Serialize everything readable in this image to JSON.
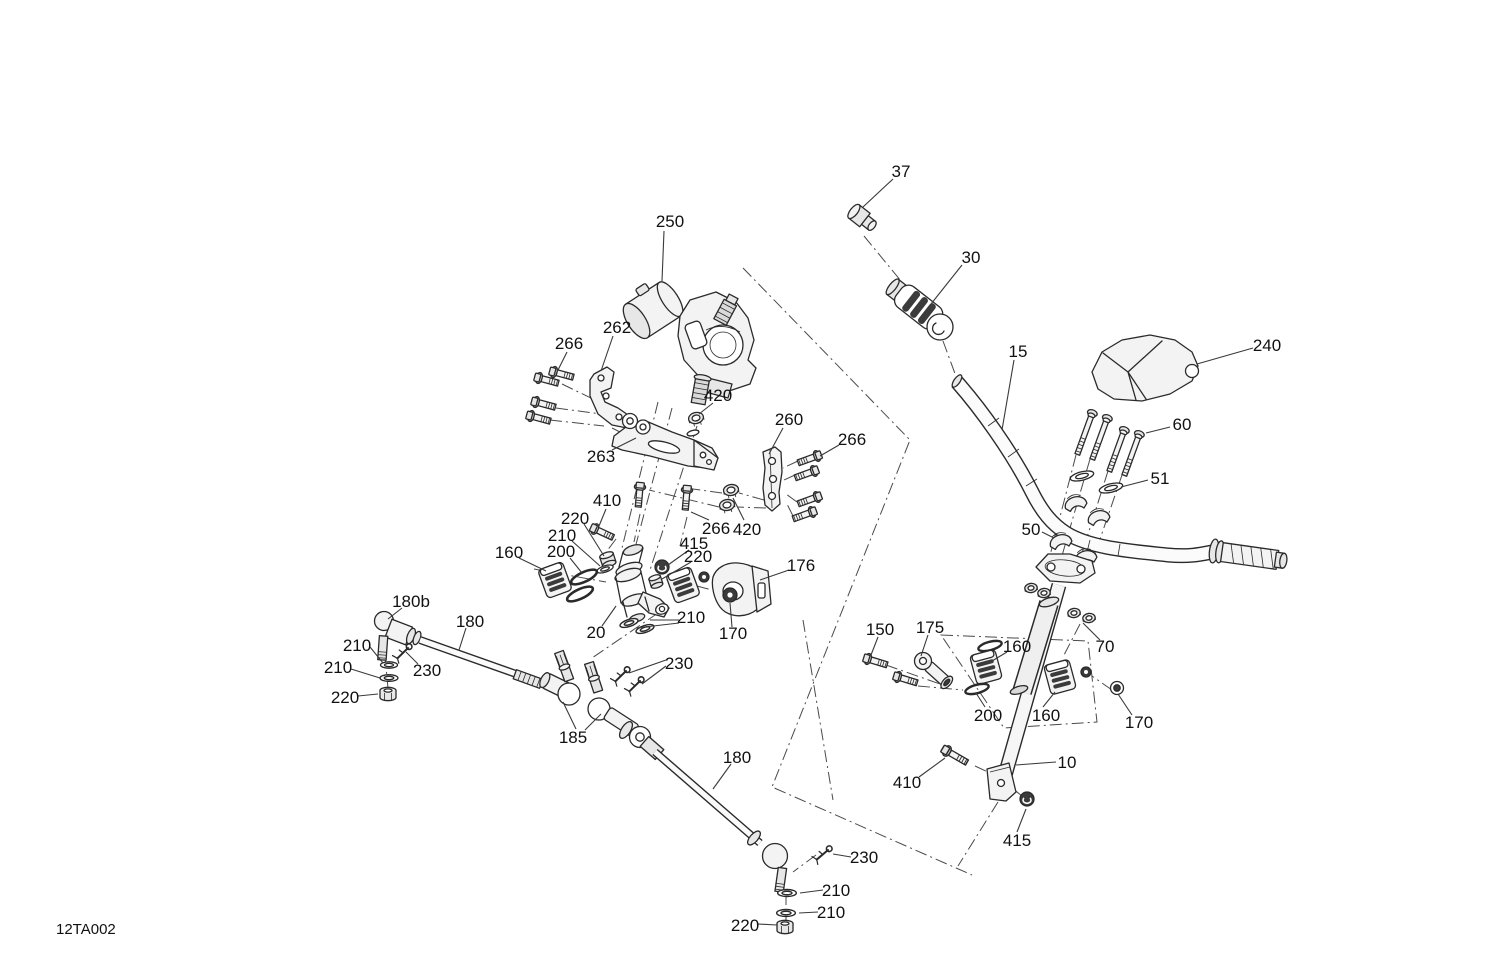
{
  "diagram": {
    "code": "12TA002",
    "background": "#ffffff",
    "line_color": "#2a2a2a",
    "label_color": "#111111",
    "callouts": [
      {
        "id": "37",
        "text": "37",
        "x": 901,
        "y": 171,
        "leaders": [
          [
            893,
            179,
            863,
            207
          ]
        ]
      },
      {
        "id": "250",
        "text": "250",
        "x": 670,
        "y": 221,
        "leaders": [
          [
            664,
            231,
            662,
            281
          ]
        ]
      },
      {
        "id": "30",
        "text": "30",
        "x": 971,
        "y": 257,
        "leaders": [
          [
            962,
            265,
            931,
            304
          ]
        ]
      },
      {
        "id": "15",
        "text": "15",
        "x": 1018,
        "y": 351,
        "leaders": [
          [
            1014,
            360,
            1002,
            430
          ]
        ]
      },
      {
        "id": "240",
        "text": "240",
        "x": 1267,
        "y": 345,
        "leaders": [
          [
            1253,
            348,
            1197,
            364
          ]
        ]
      },
      {
        "id": "266-left",
        "text": "266",
        "x": 569,
        "y": 343,
        "leaders": [
          [
            567,
            352,
            556,
            374
          ]
        ]
      },
      {
        "id": "262",
        "text": "262",
        "x": 617,
        "y": 327,
        "leaders": [
          [
            613,
            336,
            601,
            371
          ]
        ]
      },
      {
        "id": "420-upper",
        "text": "420",
        "x": 718,
        "y": 395,
        "leaders": [
          [
            713,
            403,
            699,
            414
          ]
        ]
      },
      {
        "id": "260",
        "text": "260",
        "x": 789,
        "y": 419,
        "leaders": [
          [
            783,
            428,
            769,
            454
          ]
        ]
      },
      {
        "id": "266-right",
        "text": "266",
        "x": 852,
        "y": 439,
        "leaders": [
          [
            839,
            445,
            820,
            456
          ]
        ]
      },
      {
        "id": "60",
        "text": "60",
        "x": 1182,
        "y": 424,
        "leaders": [
          [
            1170,
            427,
            1146,
            433
          ]
        ]
      },
      {
        "id": "263",
        "text": "263",
        "x": 601,
        "y": 456,
        "leaders": [
          [
            612,
            450,
            636,
            438
          ]
        ]
      },
      {
        "id": "51",
        "text": "51",
        "x": 1160,
        "y": 478,
        "leaders": [
          [
            1148,
            480,
            1121,
            487
          ]
        ]
      },
      {
        "id": "410-left",
        "text": "410",
        "x": 607,
        "y": 500,
        "leaders": [
          [
            606,
            509,
            599,
            526
          ]
        ]
      },
      {
        "id": "220-a",
        "text": "220",
        "x": 575,
        "y": 518,
        "leaders": [
          [
            584,
            524,
            604,
            556
          ]
        ]
      },
      {
        "id": "50",
        "text": "50",
        "x": 1031,
        "y": 529,
        "leaders": [
          [
            1042,
            532,
            1054,
            538
          ]
        ]
      },
      {
        "id": "266-bottom",
        "text": "266",
        "x": 716,
        "y": 528,
        "leaders": [
          [
            709,
            520,
            691,
            512
          ]
        ]
      },
      {
        "id": "420-bottom",
        "text": "420",
        "x": 747,
        "y": 529,
        "leaders": [
          [
            744,
            520,
            733,
            498
          ]
        ]
      },
      {
        "id": "210-a",
        "text": "210",
        "x": 562,
        "y": 535,
        "leaders": [
          [
            572,
            541,
            600,
            566
          ]
        ]
      },
      {
        "id": "415-a",
        "text": "415",
        "x": 694,
        "y": 543,
        "leaders": [
          [
            689,
            550,
            668,
            565
          ]
        ]
      },
      {
        "id": "200-a",
        "text": "200",
        "x": 561,
        "y": 551,
        "leaders": [
          [
            570,
            558,
            582,
            573
          ]
        ]
      },
      {
        "id": "160-a",
        "text": "160",
        "x": 509,
        "y": 552,
        "leaders": [
          [
            519,
            558,
            546,
            571
          ]
        ]
      },
      {
        "id": "220-b",
        "text": "220",
        "x": 698,
        "y": 556,
        "leaders": [
          [
            691,
            562,
            662,
            579
          ]
        ]
      },
      {
        "id": "176",
        "text": "176",
        "x": 801,
        "y": 565,
        "leaders": [
          [
            789,
            570,
            760,
            580
          ]
        ]
      },
      {
        "id": "180b",
        "text": "180b",
        "x": 411,
        "y": 601,
        "leaders": [
          [
            402,
            608,
            388,
            619
          ]
        ]
      },
      {
        "id": "210-mid",
        "text": "210",
        "x": 691,
        "y": 617,
        "leaders": [
          [
            679,
            620,
            650,
            620
          ],
          [
            679,
            623,
            636,
            628
          ]
        ]
      },
      {
        "id": "180-upper",
        "text": "180",
        "x": 470,
        "y": 621,
        "leaders": [
          [
            466,
            628,
            459,
            650
          ]
        ]
      },
      {
        "id": "20",
        "text": "20",
        "x": 596,
        "y": 632,
        "leaders": [
          [
            602,
            626,
            616,
            606
          ]
        ]
      },
      {
        "id": "170-left",
        "text": "170",
        "x": 733,
        "y": 633,
        "leaders": [
          [
            732,
            627,
            730,
            603
          ]
        ]
      },
      {
        "id": "150",
        "text": "150",
        "x": 880,
        "y": 629,
        "leaders": [
          [
            878,
            637,
            871,
            655
          ]
        ]
      },
      {
        "id": "175",
        "text": "175",
        "x": 930,
        "y": 627,
        "leaders": [
          [
            928,
            635,
            921,
            656
          ]
        ]
      },
      {
        "id": "160-ru",
        "text": "160",
        "x": 1017,
        "y": 646,
        "leaders": [
          [
            1007,
            652,
            992,
            661
          ]
        ]
      },
      {
        "id": "70",
        "text": "70",
        "x": 1105,
        "y": 646,
        "leaders": [
          [
            1100,
            640,
            1083,
            623
          ]
        ]
      },
      {
        "id": "210-l1",
        "text": "210",
        "x": 357,
        "y": 645,
        "leaders": [
          [
            370,
            647,
            383,
            663
          ]
        ]
      },
      {
        "id": "210-l2",
        "text": "210",
        "x": 338,
        "y": 667,
        "leaders": [
          [
            351,
            669,
            380,
            678
          ]
        ]
      },
      {
        "id": "230-upper",
        "text": "230",
        "x": 427,
        "y": 670,
        "leaders": [
          [
            418,
            664,
            406,
            652
          ]
        ]
      },
      {
        "id": "230-center",
        "text": "230",
        "x": 679,
        "y": 663,
        "leaders": [
          [
            666,
            660,
            629,
            673
          ],
          [
            666,
            666,
            642,
            684
          ]
        ]
      },
      {
        "id": "220-l",
        "text": "220",
        "x": 345,
        "y": 697,
        "leaders": [
          [
            358,
            696,
            378,
            694
          ]
        ]
      },
      {
        "id": "200-r",
        "text": "200",
        "x": 988,
        "y": 715,
        "leaders": [
          [
            985,
            707,
            976,
            693
          ]
        ]
      },
      {
        "id": "160-rl",
        "text": "160",
        "x": 1046,
        "y": 715,
        "leaders": [
          [
            1043,
            707,
            1055,
            692
          ]
        ]
      },
      {
        "id": "170-right",
        "text": "170",
        "x": 1139,
        "y": 722,
        "leaders": [
          [
            1132,
            715,
            1118,
            694
          ]
        ]
      },
      {
        "id": "185",
        "text": "185",
        "x": 573,
        "y": 737,
        "leaders": [
          [
            576,
            729,
            563,
            702
          ],
          [
            585,
            730,
            601,
            714
          ]
        ]
      },
      {
        "id": "180-lower",
        "text": "180",
        "x": 737,
        "y": 757,
        "leaders": [
          [
            731,
            764,
            713,
            789
          ]
        ]
      },
      {
        "id": "10",
        "text": "10",
        "x": 1067,
        "y": 762,
        "leaders": [
          [
            1056,
            762,
            1016,
            765
          ]
        ]
      },
      {
        "id": "410-right",
        "text": "410",
        "x": 907,
        "y": 782,
        "leaders": [
          [
            919,
            777,
            945,
            758
          ]
        ]
      },
      {
        "id": "415-right",
        "text": "415",
        "x": 1017,
        "y": 840,
        "leaders": [
          [
            1017,
            832,
            1026,
            809
          ]
        ]
      },
      {
        "id": "230-bottom",
        "text": "230",
        "x": 864,
        "y": 857,
        "leaders": [
          [
            851,
            857,
            833,
            854
          ]
        ]
      },
      {
        "id": "210-b1",
        "text": "210",
        "x": 836,
        "y": 890,
        "leaders": [
          [
            823,
            890,
            800,
            893
          ]
        ]
      },
      {
        "id": "210-b2",
        "text": "210",
        "x": 831,
        "y": 912,
        "leaders": [
          [
            818,
            912,
            799,
            913
          ]
        ]
      },
      {
        "id": "220-bottom",
        "text": "220",
        "x": 745,
        "y": 925,
        "leaders": [
          [
            758,
            924,
            777,
            925
          ]
        ]
      }
    ]
  }
}
